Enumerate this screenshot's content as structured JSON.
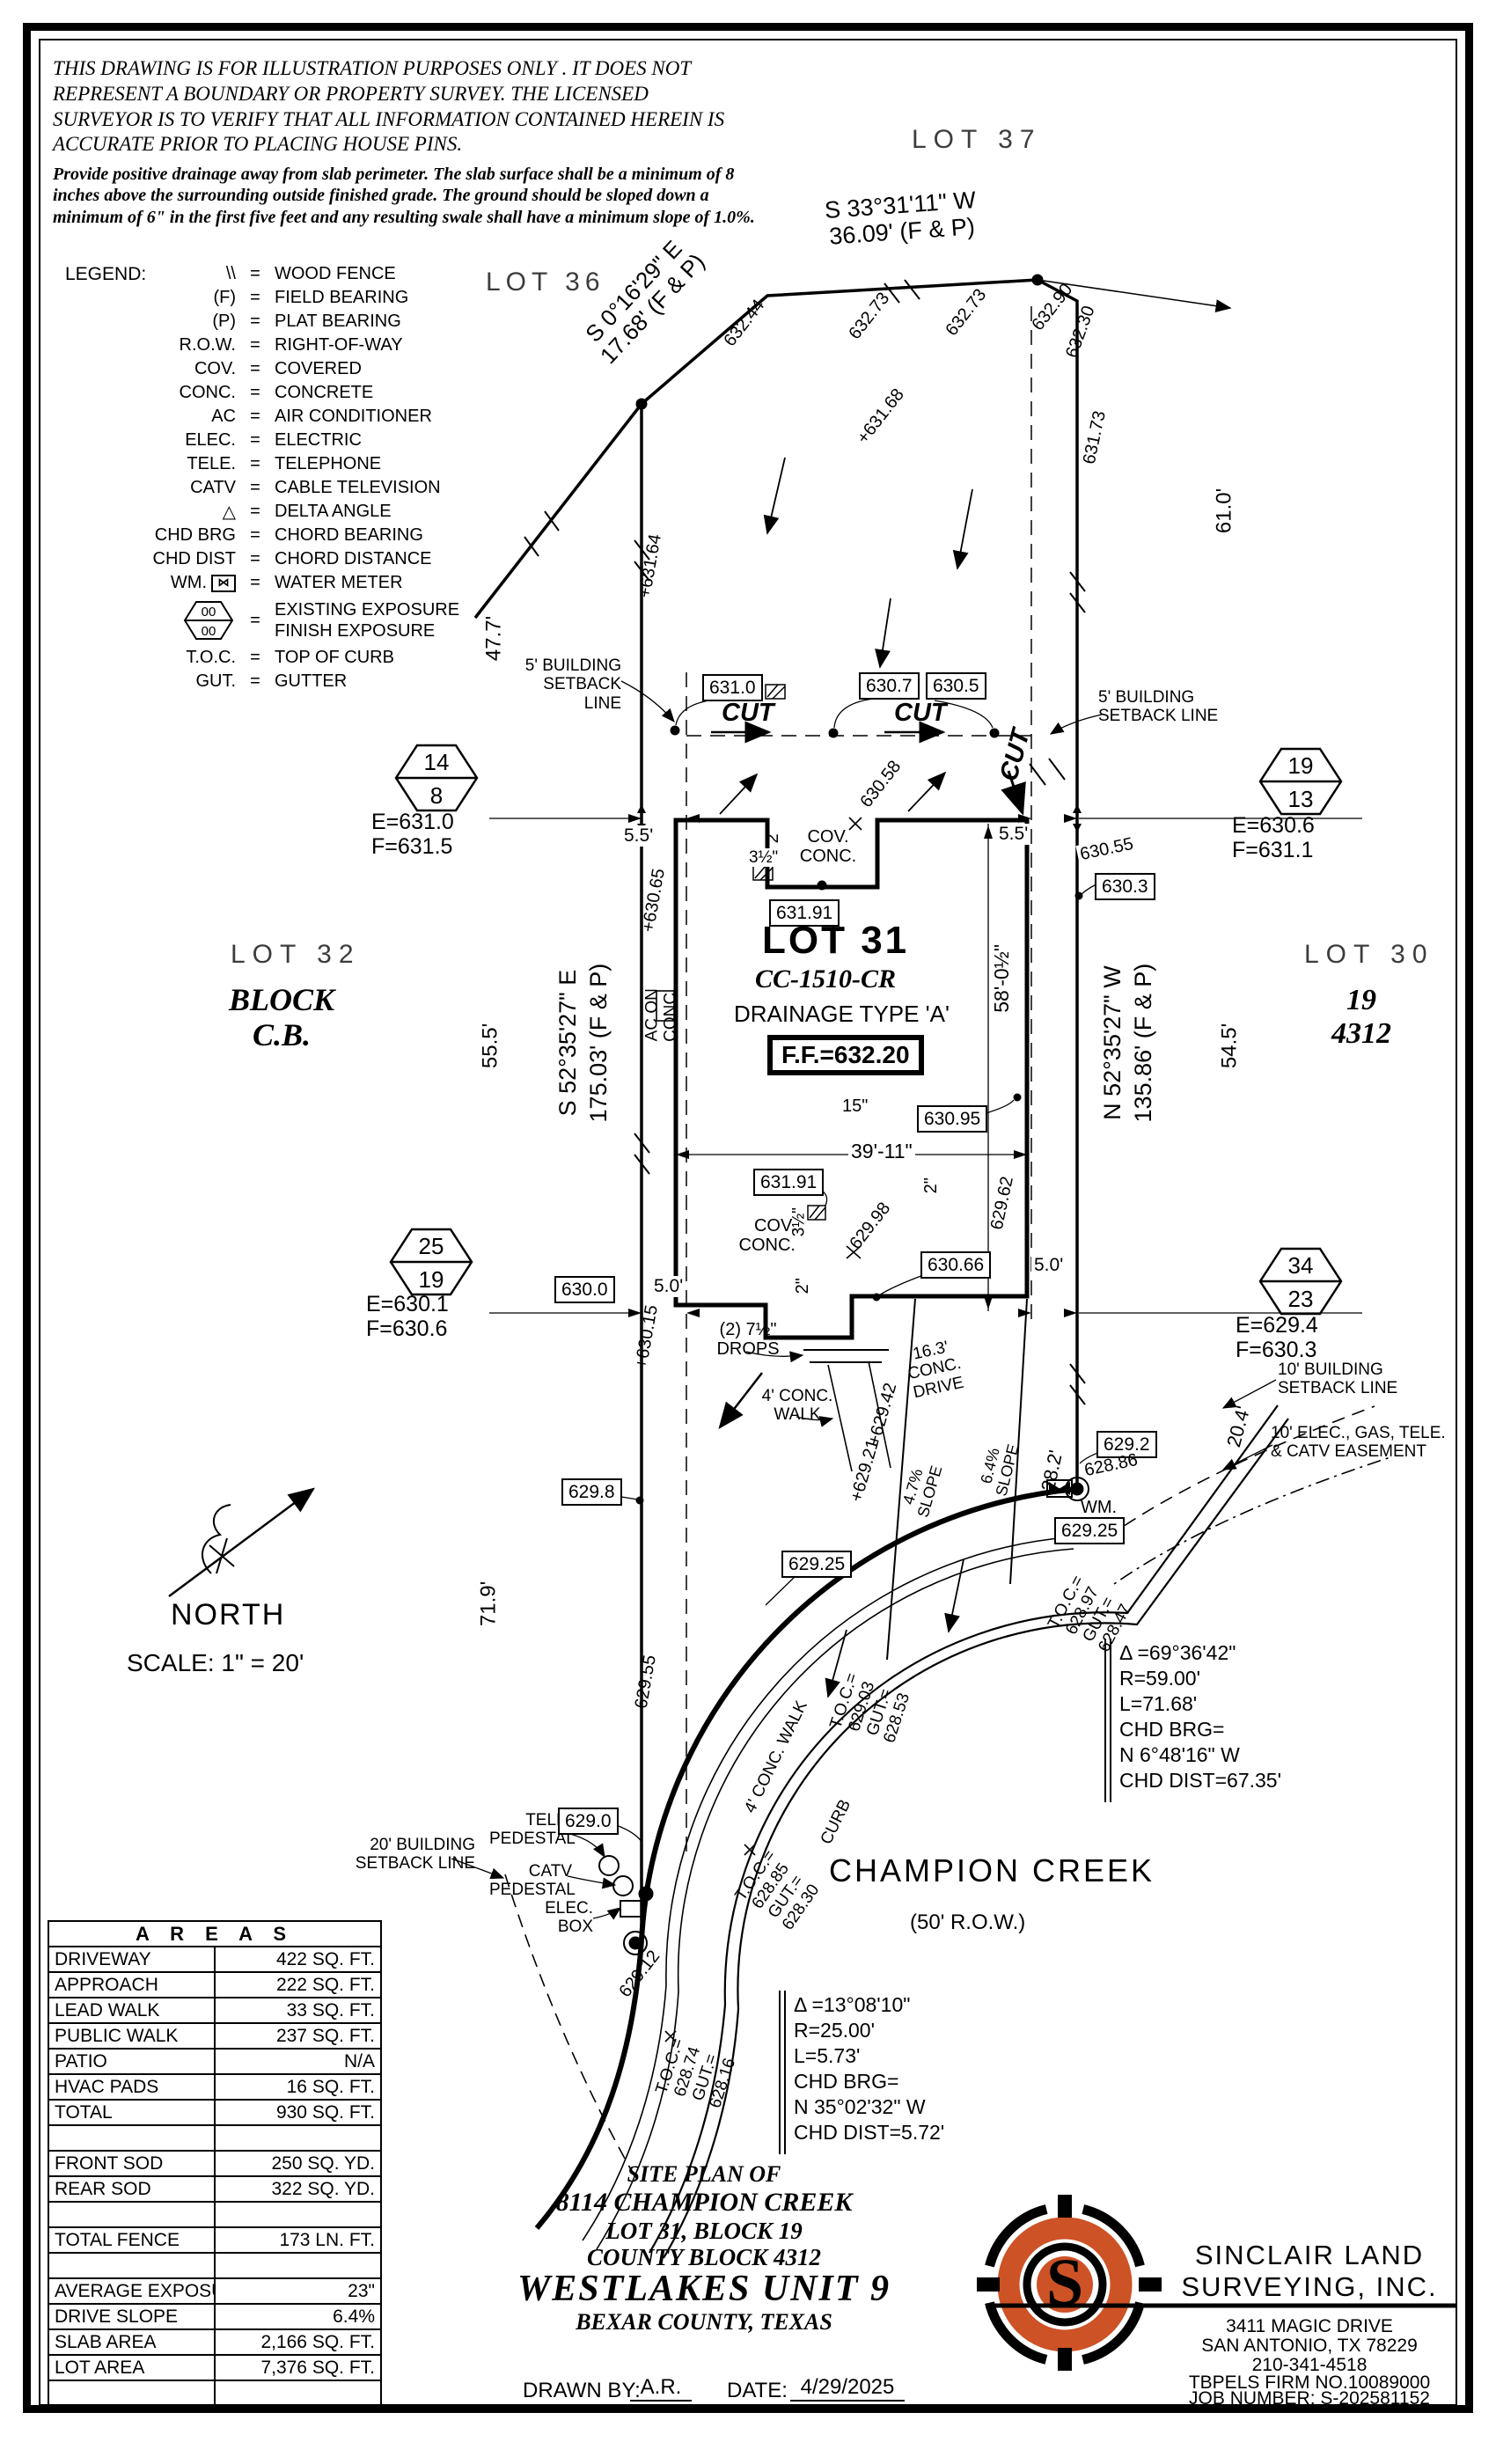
{
  "disclaimer": {
    "heading": "THIS DRAWING IS FOR ILLUSTRATION PURPOSES ONLY . IT DOES NOT REPRESENT A BOUNDARY OR PROPERTY SURVEY. THE LICENSED SURVEYOR IS TO VERIFY THAT ALL INFORMATION CONTAINED HEREIN IS ACCURATE PRIOR TO PLACING HOUSE PINS.",
    "body": "Provide positive drainage away from slab perimeter. The slab surface shall be a minimum of 8 inches above the surrounding outside finished grade. The ground should be sloped down a minimum of 6\" in the first five feet and any resulting swale shall have a minimum slope of 1.0%."
  },
  "legend": {
    "title": "LEGEND:",
    "eq": "=",
    "items": [
      {
        "sym": "\\\\",
        "def": "WOOD FENCE"
      },
      {
        "sym": "(F)",
        "def": "FIELD BEARING"
      },
      {
        "sym": "(P)",
        "def": "PLAT BEARING"
      },
      {
        "sym": "R.O.W.",
        "def": "RIGHT-OF-WAY"
      },
      {
        "sym": "COV.",
        "def": "COVERED"
      },
      {
        "sym": "CONC.",
        "def": "CONCRETE"
      },
      {
        "sym": "AC",
        "def": "AIR CONDITIONER"
      },
      {
        "sym": "ELEC.",
        "def": "ELECTRIC"
      },
      {
        "sym": "TELE.",
        "def": "TELEPHONE"
      },
      {
        "sym": "CATV",
        "def": "CABLE TELEVISION"
      },
      {
        "sym": "△",
        "def": "DELTA ANGLE"
      },
      {
        "sym": "CHD BRG",
        "def": "CHORD BEARING"
      },
      {
        "sym": "CHD DIST",
        "def": "CHORD DISTANCE"
      },
      {
        "sym": "WM.",
        "def": "WATER METER"
      },
      {
        "sym": "T.O.C.",
        "def": "TOP OF CURB"
      },
      {
        "sym": "GUT.",
        "def": "GUTTER"
      }
    ],
    "exposure": {
      "top": "00",
      "bottom": "00",
      "def1": "EXISTING EXPOSURE",
      "def2": "FINISH EXPOSURE"
    },
    "wm_glyph": "⋈"
  },
  "lots": {
    "lot37": "LOT 37",
    "lot36": "LOT 36",
    "lot32": "LOT 32",
    "block_cb": "BLOCK\nC.B.",
    "lot30": "LOT 30",
    "lot30_sub": "19\n4312",
    "lot31": "LOT 31",
    "lot31_id": "CC-1510-CR",
    "drainage": "DRAINAGE TYPE 'A'",
    "ff": "F.F.=632.20"
  },
  "bearings": {
    "top": "S 33°31'11\" W\n36.09'  (F & P)",
    "topleft": "S 0°16'29\" E\n17.68' (F & P)",
    "left": "S 52°35'27\" E\n175.03' (F & P)",
    "right": "N 52°35'27\" W\n135.86' (F & P)"
  },
  "dims": {
    "d47_7": "47.7'",
    "d55_5": "55.5'",
    "d71_9": "71.9'",
    "d61_0": "61.0'",
    "d54_5": "54.5'",
    "d20_4": "20.4'",
    "d28_2": "28.2'",
    "d58": "58'-0½\"",
    "d39": "39'-11\"",
    "d5_5": "5.5'",
    "d5_0": "5.0'",
    "d15": "15\"",
    "d2": "2\"",
    "d3h": "3½\"",
    "d16_3": "16.3'",
    "drops": "(2) 7½\"\nDROPS"
  },
  "setbacks": {
    "s5": "5' BUILDING\nSETBACK LINE",
    "s10": "10' BUILDING\nSETBACK LINE",
    "ease": "10' ELEC., GAS, TELE.\n& CATV EASEMENT",
    "s20": "20' BUILDING\nSETBACK LINE"
  },
  "site_notes": {
    "cut": "CUT",
    "cov_conc": "COV.\nCONC.",
    "ac": "AC ON\nCONC.",
    "walk": "4' CONC.\nWALK",
    "walk2": "4' CONC. WALK",
    "drive": "16.3'\nCONC.\nDRIVE",
    "curb": "CURB",
    "slope64": "6.4%\nSLOPE",
    "slope47": "4.7%\nSLOPE",
    "wm": "WM.",
    "tele": "TELE.\nPEDESTAL",
    "catv": "CATV\nPEDESTAL",
    "elec": "ELEC.\nBOX"
  },
  "elevations": {
    "boxed": {
      "v631_0": "631.0",
      "v630_7": "630.7",
      "v630_5": "630.5",
      "v630_3": "630.3",
      "v631_91": "631.91",
      "v630_95": "630.95",
      "v630_66": "630.66",
      "v630_0": "630.0",
      "v629_8": "629.8",
      "v629_2": "629.2",
      "v629_25": "629.25",
      "v629_0": "629.0"
    },
    "plain": {
      "v630_55": "630.55",
      "v628_86": "628.86"
    },
    "spot": {
      "v632_44": "632.44",
      "v632_73": "632.73",
      "v632_90": "632.90",
      "v632_30": "632.30",
      "v631_68": "+631.68",
      "v631_73": "631.73",
      "v631_64": "+631.64",
      "v630_65": "+630.65",
      "v630_58": "630.58",
      "v629_98": "629.98",
      "v629_62": "629.62",
      "v630_15": "+630.15",
      "v629_55": "629.55",
      "v629_21": "+629.21",
      "v629_42": "+629.42",
      "v629_12": "629.12"
    },
    "toc": {
      "a": "T.O.C.=\n628.74\nGUT.=\n628.16",
      "b": "T.O.C.=\n628.85\nGUT.=\n628.30",
      "c": "T.O.C.=\n629.03\nGUT.=\n628.53",
      "d": "T.O.C.=\n628.97\nGUT.=\n628.47"
    }
  },
  "hex_markers": [
    {
      "top": "14",
      "bottom": "8",
      "e": "E=631.0",
      "f": "F=631.5"
    },
    {
      "top": "19",
      "bottom": "13",
      "e": "E=630.6",
      "f": "F=631.1"
    },
    {
      "top": "25",
      "bottom": "19",
      "e": "E=630.1",
      "f": "F=630.6"
    },
    {
      "top": "34",
      "bottom": "23",
      "e": "E=629.4",
      "f": "F=630.3"
    }
  ],
  "street": {
    "name": "CHAMPION CREEK",
    "row": "(50' R.O.W.)"
  },
  "north": {
    "label": "NORTH",
    "scale": "SCALE:  1\" =  20'"
  },
  "curves": [
    {
      "lines": "Δ =69°36'42\"\nR=59.00'\nL=71.68'\nCHD BRG=\nN 6°48'16\" W\nCHD DIST=67.35'"
    },
    {
      "lines": "Δ =13°08'10\"\nR=25.00'\nL=5.73'\nCHD BRG=\nN 35°02'32\" W\nCHD DIST=5.72'"
    }
  ],
  "areas_table": {
    "title": "A R E A S",
    "rows": [
      [
        "DRIVEWAY",
        "422 SQ. FT."
      ],
      [
        "APPROACH",
        "222 SQ. FT."
      ],
      [
        "LEAD WALK",
        "33 SQ. FT."
      ],
      [
        "PUBLIC WALK",
        "237 SQ. FT."
      ],
      [
        "PATIO",
        "N/A"
      ],
      [
        "HVAC PADS",
        "16 SQ. FT."
      ],
      [
        "TOTAL",
        "930 SQ. FT."
      ],
      [
        "",
        ""
      ],
      [
        "FRONT SOD",
        "250 SQ. YD."
      ],
      [
        "REAR SOD",
        "322 SQ. YD."
      ],
      [
        "",
        ""
      ],
      [
        "TOTAL FENCE",
        "173 LN. FT."
      ],
      [
        "",
        ""
      ],
      [
        "AVERAGE EXPOSURE",
        "23\""
      ],
      [
        "DRIVE SLOPE",
        "6.4%"
      ],
      [
        "SLAB AREA",
        "2,166 SQ. FT."
      ],
      [
        "LOT AREA",
        "7,376 SQ. FT."
      ],
      [
        "",
        ""
      ]
    ]
  },
  "title_block": {
    "l1": "SITE PLAN OF",
    "l2": "8114 CHAMPION CREEK",
    "l3": "LOT 31, BLOCK 19",
    "l4": "COUNTY BLOCK 4312",
    "l5": "WESTLAKES UNIT 9",
    "l6": "BEXAR COUNTY, TEXAS",
    "drawn_label": "DRAWN BY:",
    "drawn": "A.R.",
    "date_label": "DATE:",
    "date": "4/29/2025"
  },
  "company": {
    "name1": "SINCLAIR LAND",
    "name2": "SURVEYING, INC.",
    "a1": "3411 MAGIC DRIVE",
    "a2": "SAN ANTONIO, TX 78229",
    "a3": "210-341-4518",
    "a4": "TBPELS FIRM NO.10089000",
    "a5": "JOB NUMBER: S-202581152",
    "logo_letter": "S",
    "logo_orange": "#cd5226"
  }
}
